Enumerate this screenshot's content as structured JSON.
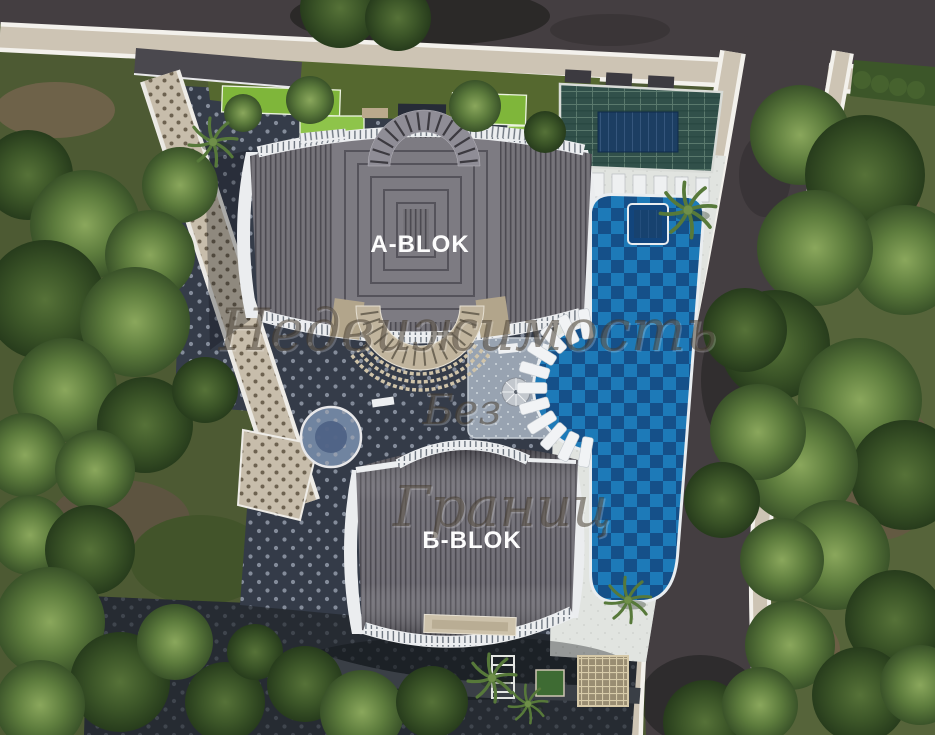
{
  "image": {
    "type": "aerial-3d-site-plan-render",
    "buildings": {
      "block_a_label": "A-BLOK",
      "block_b_label": "B-BLOK"
    },
    "watermark": {
      "line1": "Недвижимость",
      "line2": "Без",
      "line3": "Границ"
    },
    "palette": {
      "road": "#443e41",
      "sidewalk": "#cdc4b4",
      "curb_line": "#f3f1ec",
      "grass": "#4d5a33",
      "tree_light": "#5d7c3d",
      "tree_dark": "#3c5628",
      "dirt": "#6b5f45",
      "roof_gray": "#6e6c73",
      "roof_ridge": "#4b494f",
      "building_trim": "#ebedef",
      "pool_light": "#1d7ab8",
      "pool_dark": "#155089",
      "deck": "#dfe2de",
      "paver_dark": "#353c49",
      "paver_dot": "#98a0ae",
      "walkway": "#c7bdab",
      "glass_roof": "#31504a",
      "skylight_blue": "#1c3e62",
      "canopy_tan": "#c0b49d"
    }
  }
}
